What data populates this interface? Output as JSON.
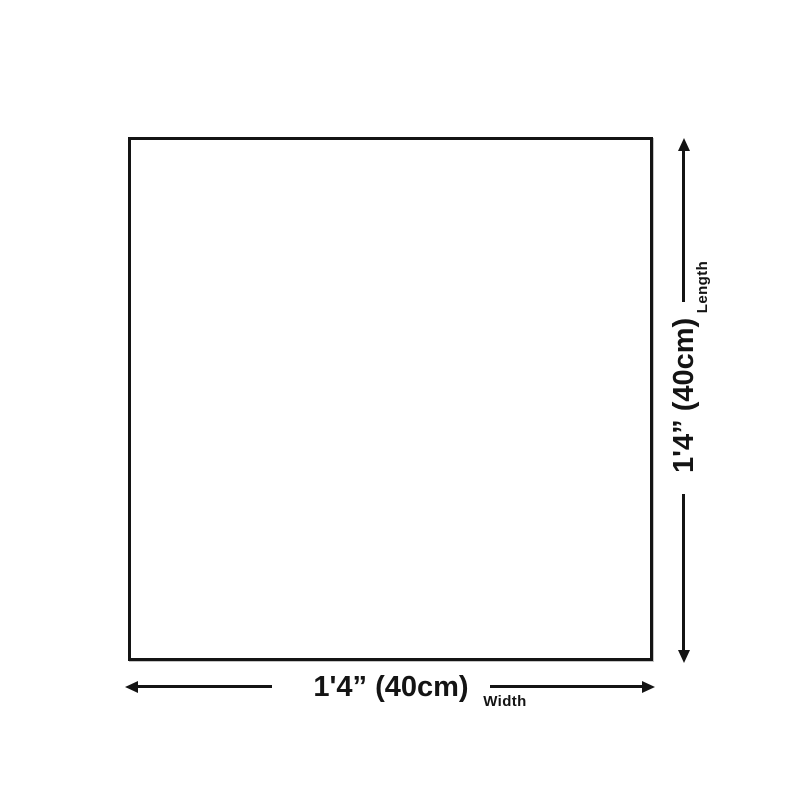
{
  "diagram": {
    "shape": "square-outline",
    "colors": {
      "line": "#141414",
      "background": "#ffffff"
    },
    "length_dimension": {
      "axis_label": "Length",
      "value": "1'4” (40cm)"
    },
    "width_dimension": {
      "axis_label": "Width",
      "value": "1'4” (40cm)"
    }
  }
}
